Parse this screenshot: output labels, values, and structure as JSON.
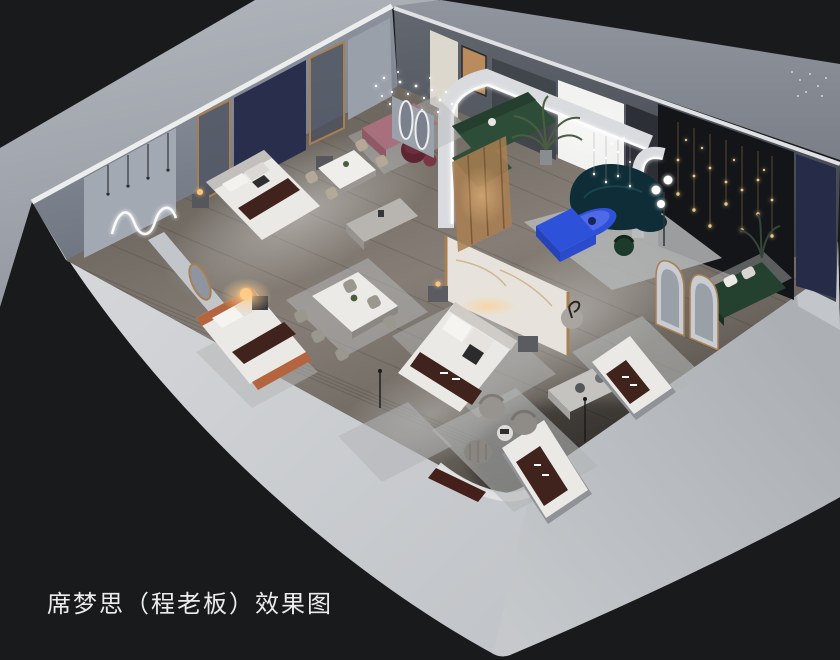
{
  "title": {
    "text": "席梦思（程老板）效果图"
  },
  "colors": {
    "background": "#191a1c",
    "backdrop": "#a8acb4",
    "backdrop_right": "#878c95",
    "wall_cap": "#e9eaec",
    "nw_wall": "#8b919c",
    "ne_wall": "#575b64",
    "podium_left": "#ced1d4",
    "podium_right": "#b2b5ba",
    "floor_wood": "#7c756d",
    "rug_gray": "#b3b5b6",
    "bed_white": "#ebe9e5",
    "runner_brown": "#40231d",
    "sofa_green": "#2e4d38",
    "sofa_teal": "#0f2d36",
    "accent_blue": "#2e51da",
    "bench_mauve": "#a8707c",
    "ottoman_burgundy": "#5c2531",
    "curtain_navy": "#292e4d",
    "wall_navy": "#262b48",
    "feature_wall_black": "#141518",
    "gold_trim": "#a97f52",
    "marble_white": "#e7e3dc",
    "terracotta": "#b4653f",
    "led_white": "#ffffff",
    "lamp_warm": "#ffc477",
    "string_light_gold": "#e6c07e",
    "plant_green": "#4a5d3f",
    "title_text": "#ececec"
  }
}
